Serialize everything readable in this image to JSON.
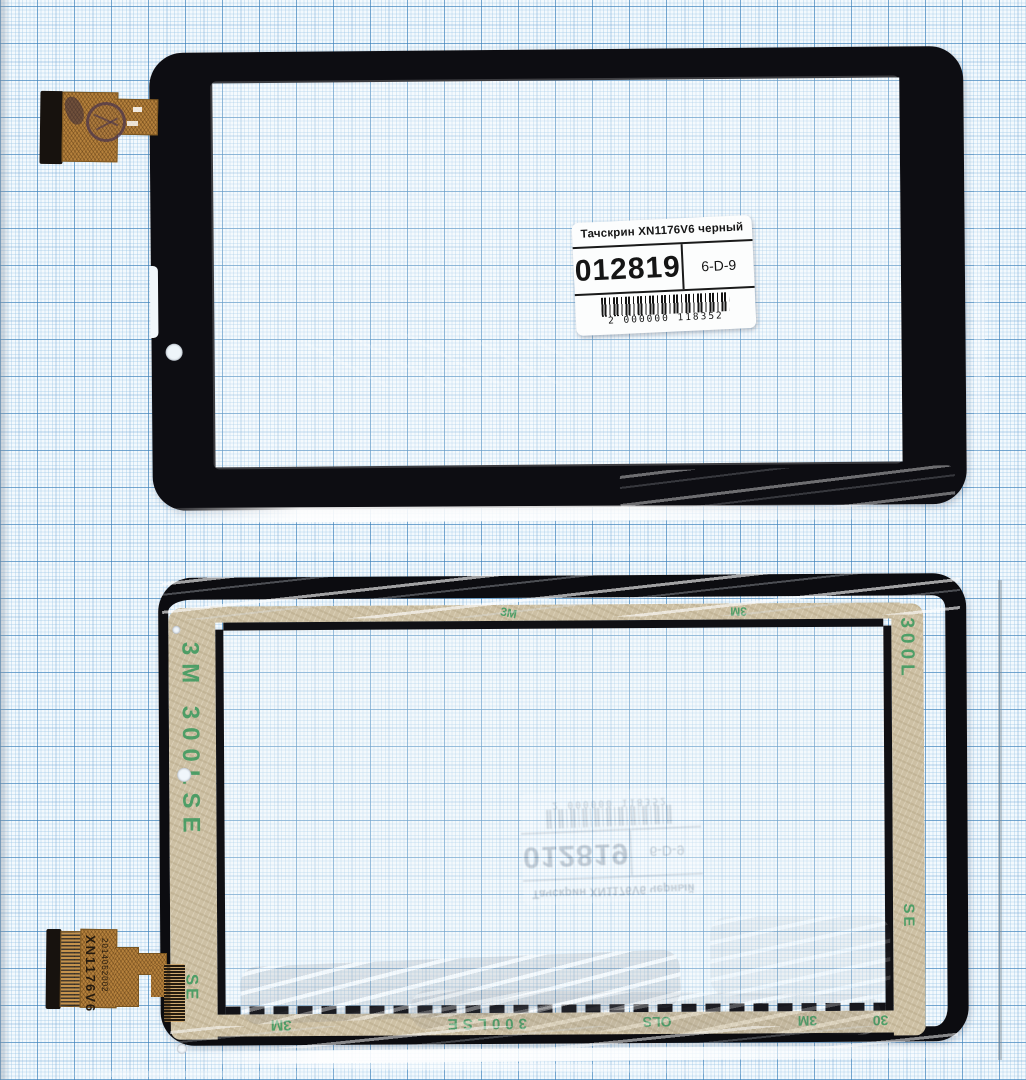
{
  "label": {
    "title": "Тачскрин XN1176V6 черный",
    "code": "012819",
    "cell": "6-D-9",
    "barcode_digits": "2 000000 118352"
  },
  "cable": {
    "model": "XN1176V6",
    "date_code": "2014052002"
  },
  "tape": {
    "brand": "3M",
    "series": "300LSE",
    "full": "3M 300LSE",
    "fragments": [
      "300L",
      "300LSE",
      "SE",
      "OLS",
      "30"
    ]
  },
  "colors": {
    "paper": "#f3f9fd",
    "grid_bold": "#5e9ed0",
    "frame_black": "#0d0d12",
    "tape_tan": "#cdc0a4",
    "tape_print_green": "#2f9658",
    "cable_gold": "#b5813c",
    "label_white": "#fcfdfd"
  }
}
